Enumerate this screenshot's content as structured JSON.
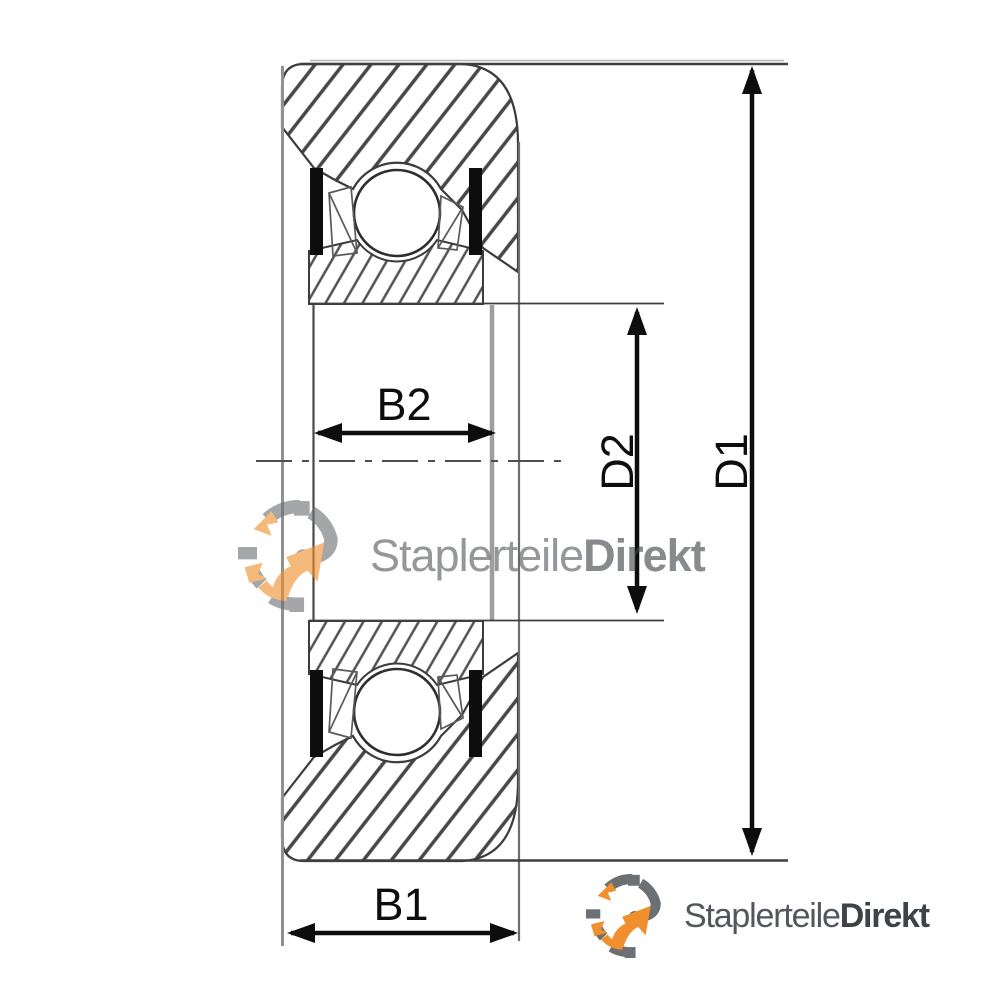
{
  "diagram": {
    "dimension_labels": {
      "b1": "B1",
      "b2": "B2",
      "d1": "D1",
      "d2": "D2"
    }
  },
  "branding": {
    "watermark": {
      "name_regular": "Staplerteile",
      "name_bold": "Direkt"
    },
    "logo": {
      "name_regular": "Staplerteile",
      "name_bold": "Direkt"
    }
  },
  "colors": {
    "ink": "#0d0d0d",
    "outline_dark": "#3c3c3c",
    "outline_gray": "#8f8f8f",
    "hatch_line": "#474747",
    "seal_black": "#0d0d0d",
    "brand_orange": "#EF8F2D",
    "brand_gray": "#6D7073",
    "brand_text": "#53575C",
    "brand_text_bold": "#3E4348"
  }
}
